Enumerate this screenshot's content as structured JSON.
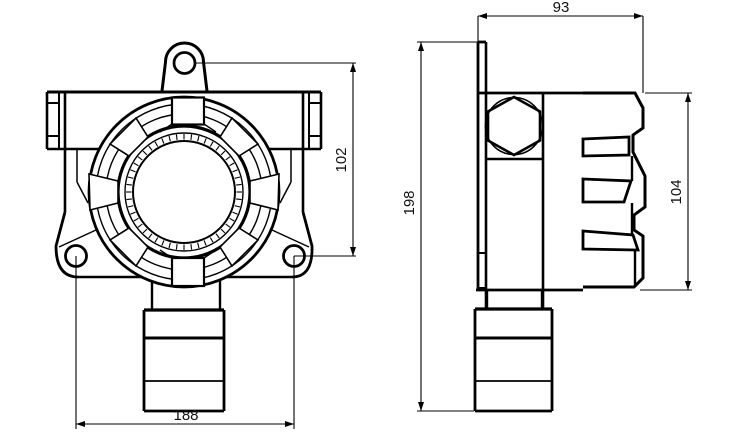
{
  "meta": {
    "drawing_title": "Fixed gas detector outline dimension drawing",
    "background_color": "#ffffff",
    "line_color": "#000000",
    "text_color": "#111111"
  },
  "views": {
    "front": {
      "name": "front view",
      "features": [
        "top mounting lug with hole",
        "left and right body flanges",
        "circular bezel with graduated dial ring (fine illegible tick markings)",
        "two lower mounting ears with holes",
        "stepped sensor housing at bottom"
      ],
      "dimensions": {
        "mount_hole_vertical_offset": {
          "value": "102",
          "orientation": "vertical"
        },
        "mount_hole_spacing": {
          "value": "188",
          "orientation": "horizontal"
        }
      }
    },
    "side": {
      "name": "side view",
      "features": [
        "flat mounting back plate",
        "hex cable-gland nut",
        "finned enclosure cover with three slots",
        "stepped sensor housing at bottom"
      ],
      "dimensions": {
        "enclosure_depth": {
          "value": "93",
          "orientation": "horizontal"
        },
        "overall_height": {
          "value": "198",
          "orientation": "vertical"
        },
        "enclosure_height": {
          "value": "104",
          "orientation": "vertical"
        }
      }
    }
  }
}
